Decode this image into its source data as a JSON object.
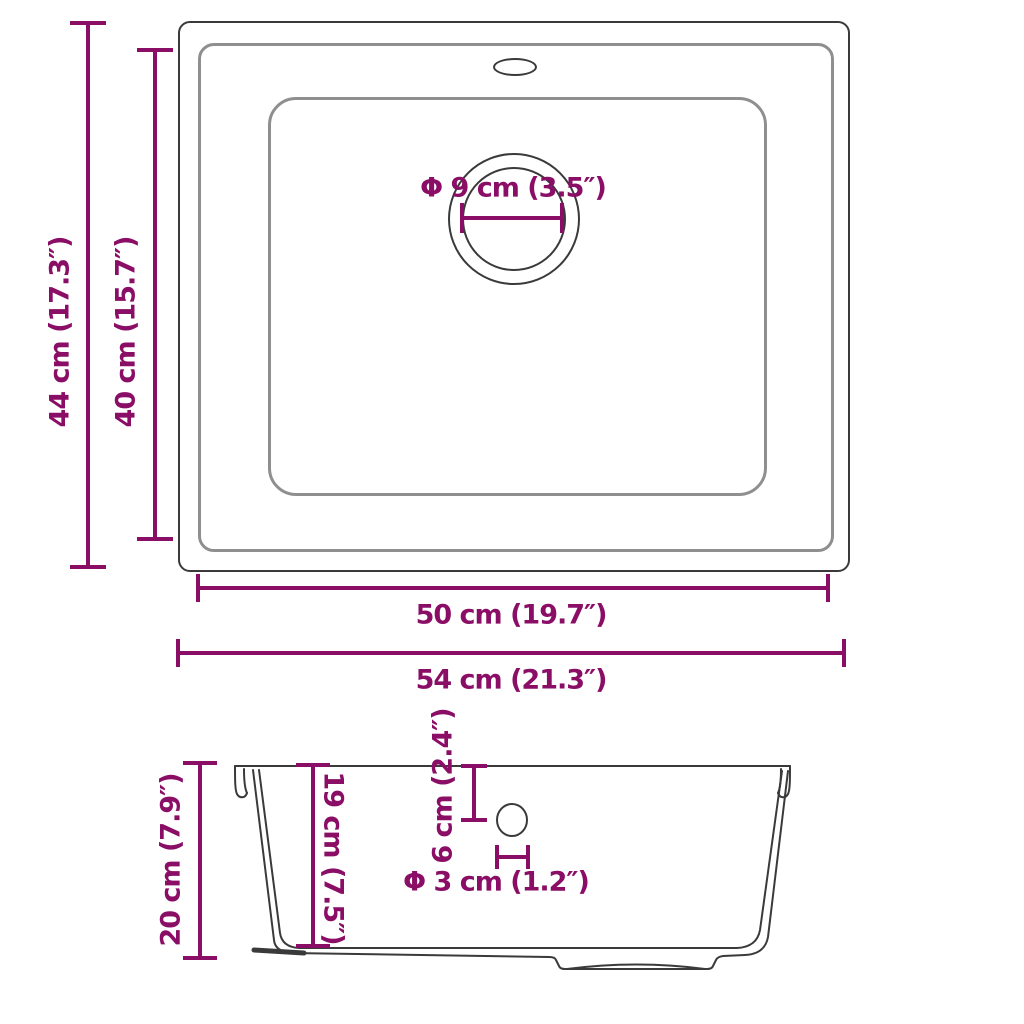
{
  "diagram_title": "kitchen sink dimension diagram",
  "colors": {
    "accent": "#8A0D66",
    "line_dark": "#3A3A3A",
    "line_mid": "#8F8F8F",
    "background": "#FFFFFF"
  },
  "top_view": {
    "outer_height_label": "44 cm (17.3″)",
    "inner_height_label": "40 cm (15.7″)",
    "drain_diameter_label": "Φ 9 cm (3.5″)",
    "inner_width_label": "50 cm (19.7″)",
    "outer_width_label": "54 cm (21.3″)"
  },
  "side_view": {
    "total_height_label": "20 cm (7.9″)",
    "bowl_depth_label": "19 cm (7.5″)",
    "drain_offset_label": "6 cm (2.4″)",
    "drain_hole_label": "Φ 3 cm (1.2″)"
  }
}
